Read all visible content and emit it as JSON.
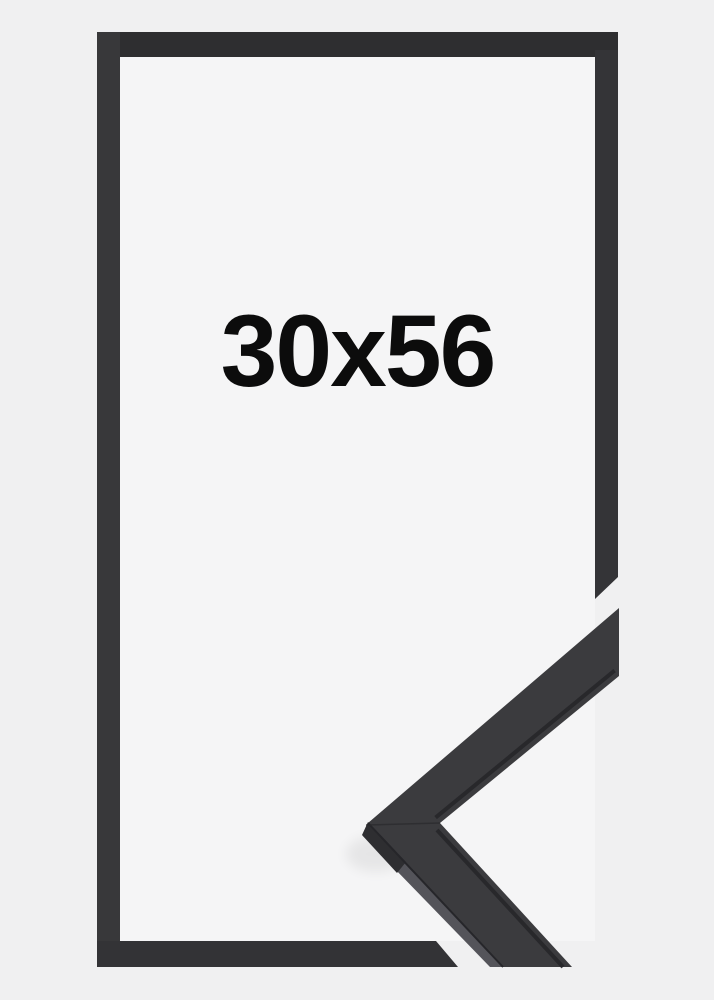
{
  "product": {
    "size_label": "30x56"
  },
  "colors": {
    "background": "#f0f0f1",
    "inner_background": "#f5f5f6",
    "frame_top": "#2e2e30",
    "frame_left": "#38383a",
    "frame_right": "#343437",
    "frame_bottom": "#333336",
    "moulding_face": "#3b3b3e",
    "moulding_side": "#54545a",
    "moulding_side_dark": "#2e2e31",
    "moulding_lip": "#26262a",
    "moulding_seam": "#2b2b2e",
    "label_text": "#0c0c0c"
  }
}
